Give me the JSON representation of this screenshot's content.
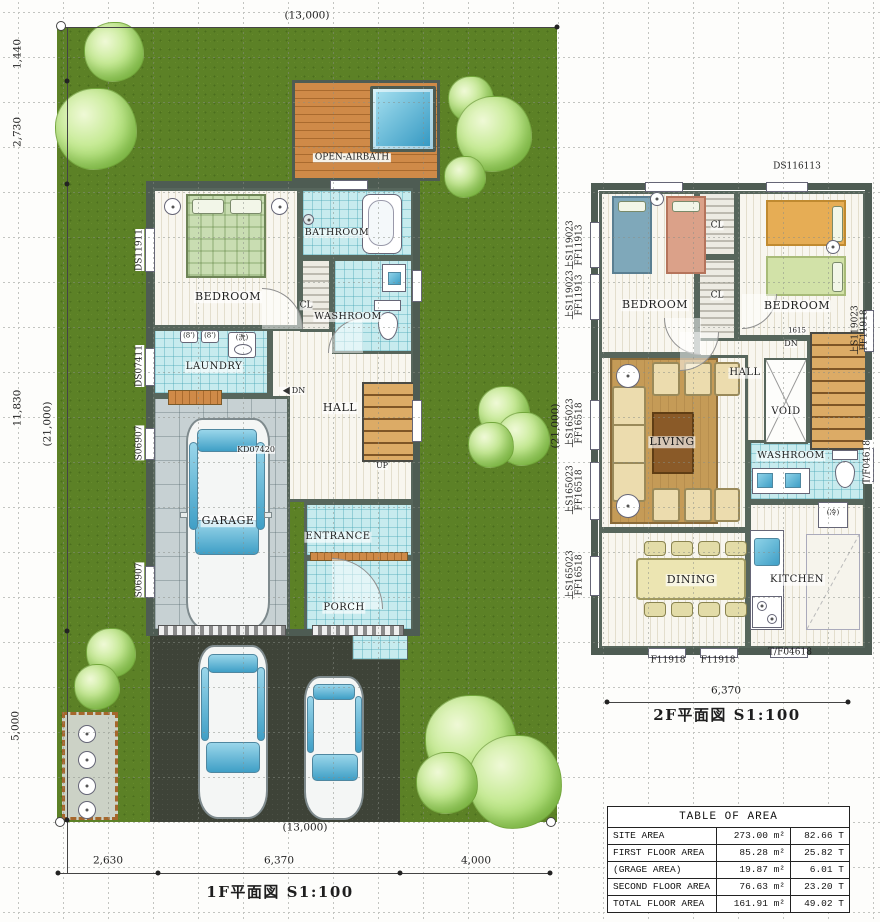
{
  "site": {
    "dim_top": "(13,000)",
    "dim_left_1": "1,440",
    "dim_left_2": "2,730",
    "dim_left_3": "11,830",
    "dim_left_total": "(21,000)",
    "dim_left_4": "5,000",
    "dim_bottom_1": "2,630",
    "dim_bottom_2": "6,370",
    "dim_bottom_3": "4,000",
    "dim_bottom_total": "(13,000)"
  },
  "plan1f": {
    "caption": "1F平面図  S1:100",
    "deck": "OPEN-AIRBATH",
    "rooms": {
      "bedroom": "BEDROOM",
      "bathroom": "BATHROOM",
      "washroom": "WASHROOM",
      "closet": "CL",
      "laundry": "LAUNDRY",
      "hall": "HALL",
      "garage": "GARAGE",
      "entrance": "ENTRANCE",
      "porch": "PORCH"
    },
    "stair_up": "UP",
    "stair_dn": "DN",
    "car_code": "KD07420",
    "washer": "(洗)",
    "cabinet1": "(8')",
    "cabinet2": "(8')",
    "codes": {
      "left1": "DS11911",
      "left2": "DS07411",
      "left3": "S06907",
      "left4": "S06907"
    }
  },
  "plan2f": {
    "caption": "2F平面図  S1:100",
    "dim_bottom": "6,370",
    "dim_left": "(21,000)",
    "rooms": {
      "bedroom_left": "BEDROOM",
      "bedroom_right": "BEDROOM",
      "closet1": "CL",
      "closet2": "CL",
      "hall": "HALL",
      "void": "VOID",
      "living": "LIVING",
      "washroom": "WASHROOM",
      "dining": "DINING",
      "kitchen": "KITCHEN"
    },
    "stair_dn": "DN",
    "stair_num": "1615",
    "fridge": "(冷)",
    "codes": {
      "top": "DS116113",
      "left1a": "上S119023",
      "left1b": "FF11913",
      "left2a": "上S119023",
      "left2b": "FF11913",
      "left3a": "上S165023",
      "left3b": "FF16518",
      "left4a": "上S165023",
      "left4b": "FF16518",
      "left5a": "上S165023",
      "left5b": "FF16518",
      "right1a": "上S119023",
      "right1b": "FF11918",
      "right2": "T/F04618",
      "bottom1": "F11918",
      "bottom2": "F11918",
      "bottom3": "T/F04618"
    }
  },
  "area_table": {
    "title": "TABLE OF AREA",
    "rows": [
      {
        "name": "SITE AREA",
        "m2": "273.00 m²",
        "tsubo": "82.66 T"
      },
      {
        "name": "FIRST FLOOR AREA",
        "m2": "85.28 m²",
        "tsubo": "25.82 T"
      },
      {
        "name": "(GRAGE AREA)",
        "m2": "19.87 m²",
        "tsubo": "6.01 T"
      },
      {
        "name": "SECOND FLOOR AREA",
        "m2": "76.63 m²",
        "tsubo": "23.20 T"
      },
      {
        "name": "TOTAL FLOOR AREA",
        "m2": "161.91 m²",
        "tsubo": "49.02 T"
      }
    ]
  }
}
